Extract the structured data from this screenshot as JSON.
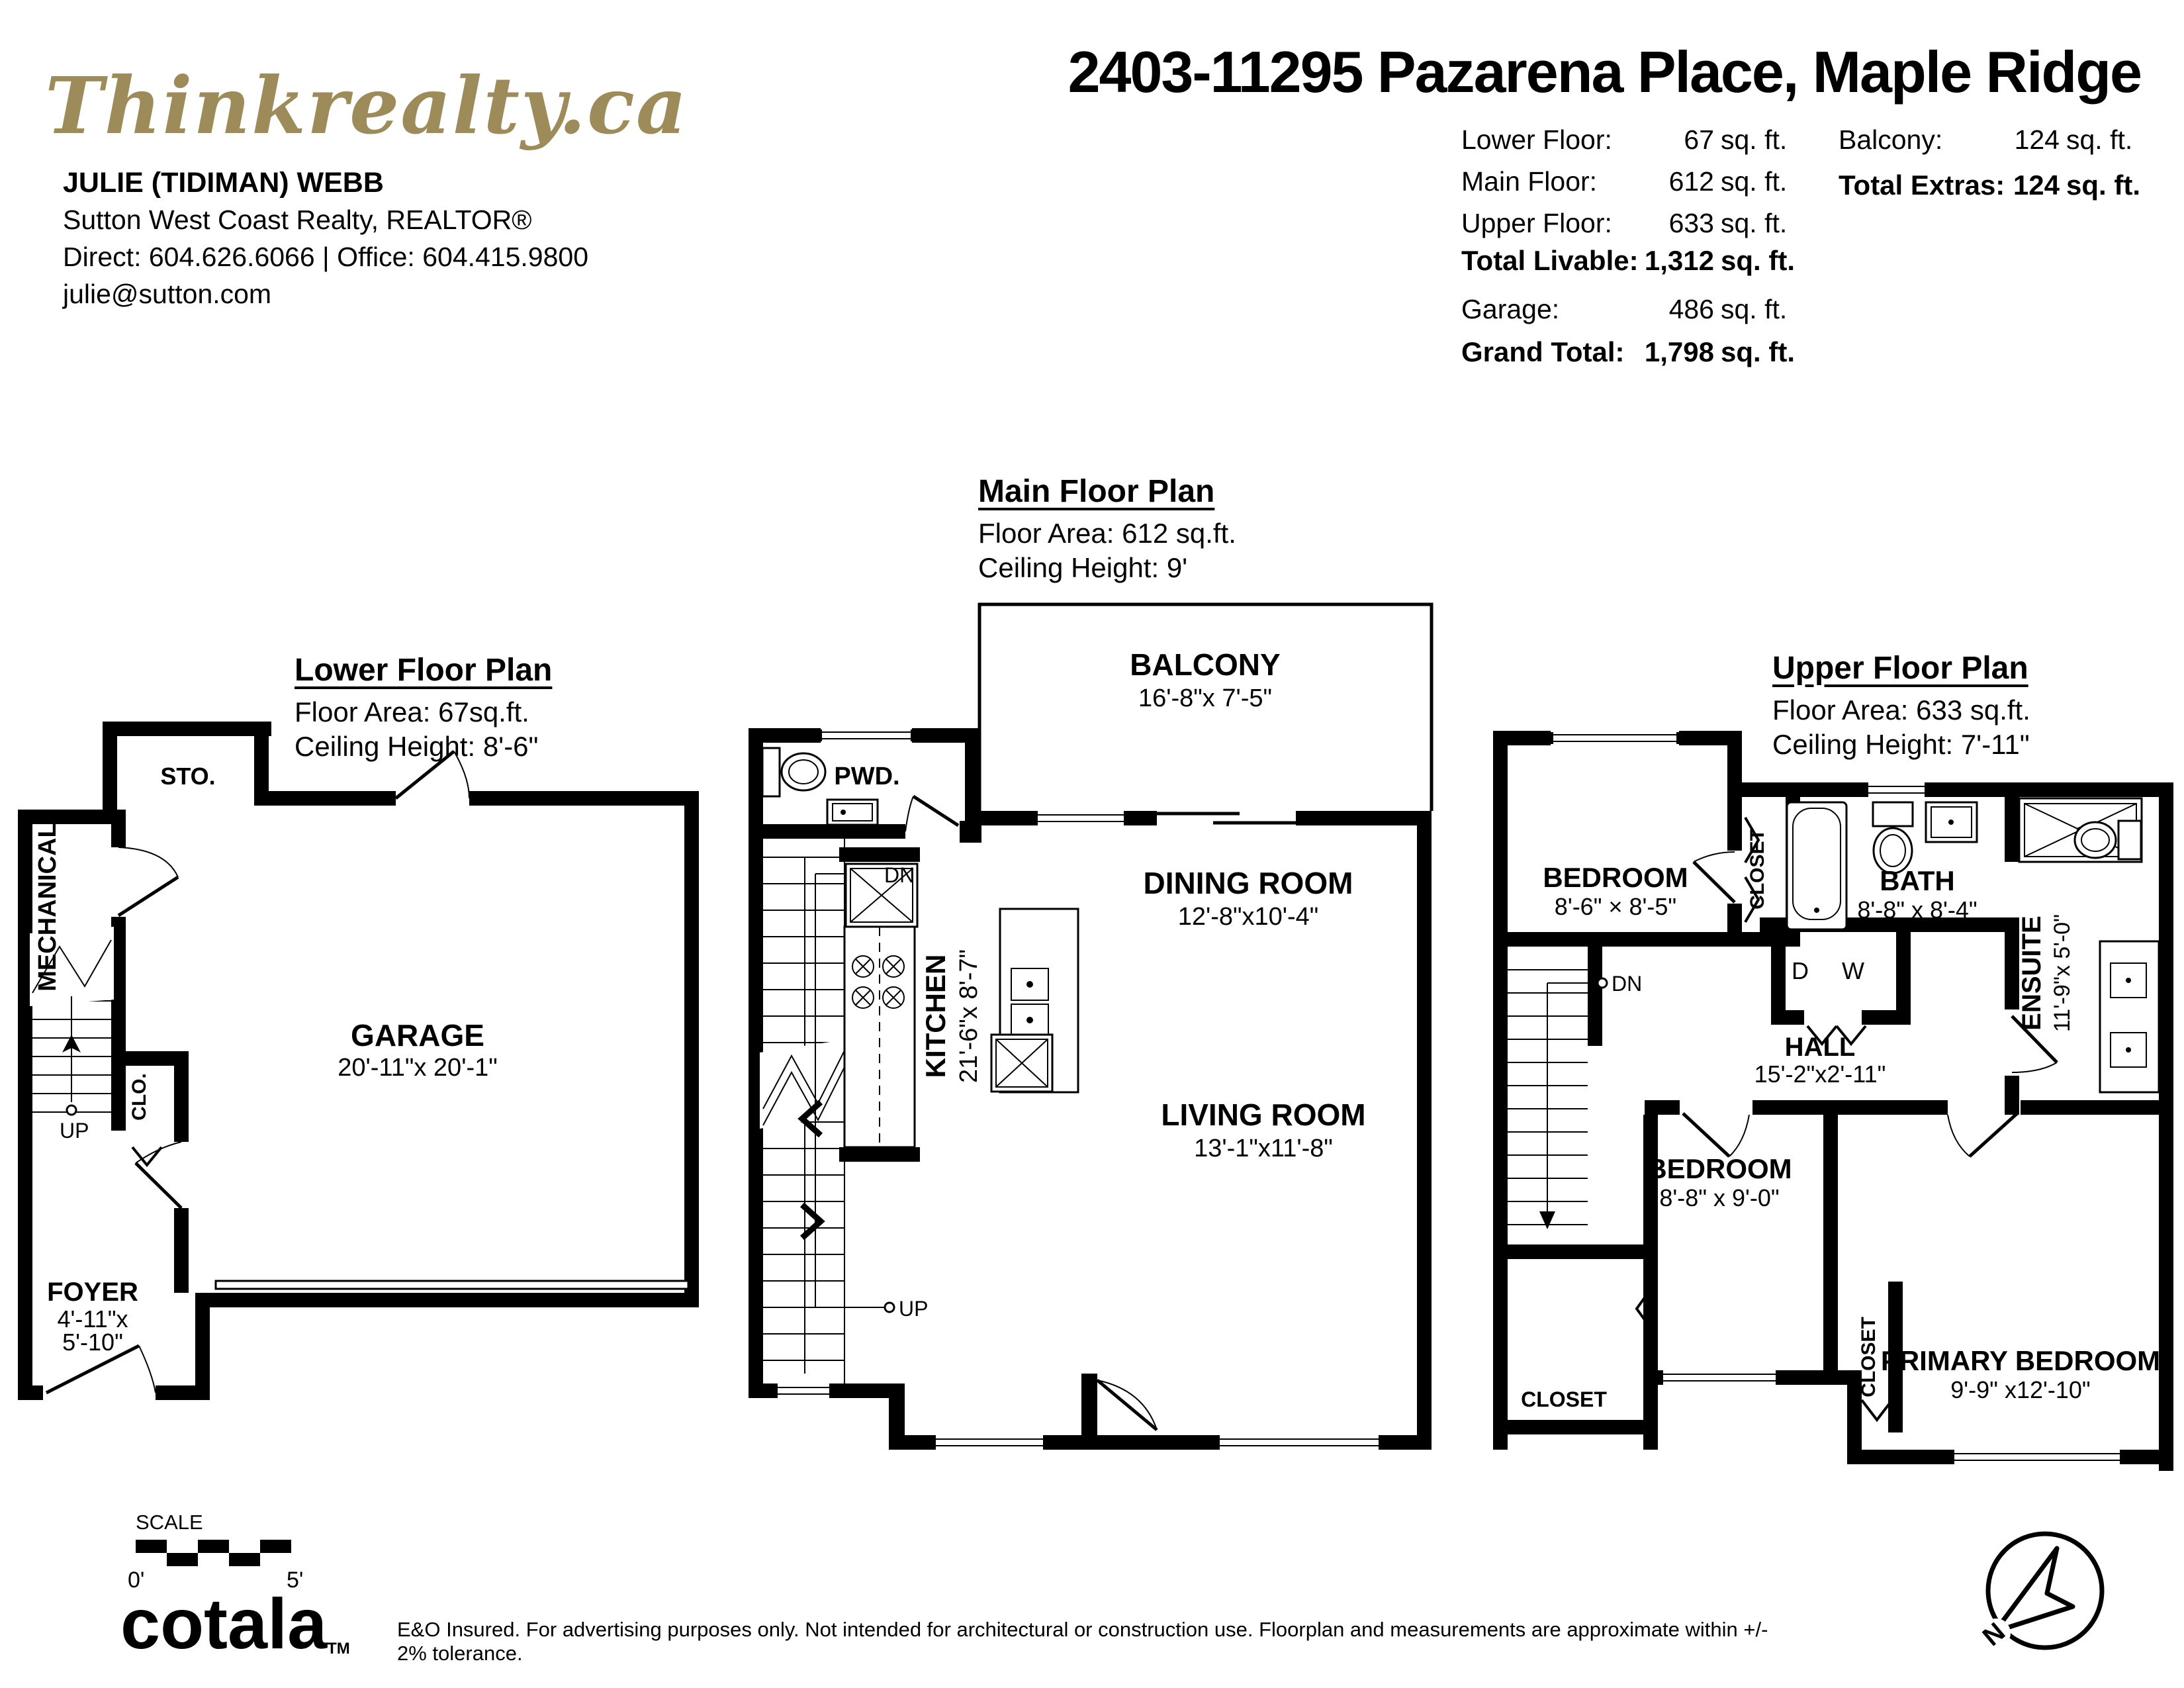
{
  "brand": {
    "logo_text": "Thinkrealty.ca",
    "logo_color": "#9d8c5a",
    "footer_brand": "cotala",
    "footer_brand_tm": "TM"
  },
  "agent": {
    "name": "JULIE (TIDIMAN) WEBB",
    "brokerage": "Sutton West Coast Realty, REALTOR®",
    "phones": "Direct: 604.626.6066 | Office: 604.415.9800",
    "email": "julie@sutton.com"
  },
  "title": "2403-11295 Pazarena Place, Maple Ridge",
  "summary": {
    "left_rows": [
      {
        "label": "Lower Floor:",
        "value": "67",
        "unit": "sq. ft."
      },
      {
        "label": "Main Floor:",
        "value": "612",
        "unit": "sq. ft."
      },
      {
        "label": "Upper Floor:",
        "value": "633",
        "unit": "sq. ft."
      },
      {
        "label": "Total Livable:",
        "value": "1,312",
        "unit": "sq. ft."
      },
      {
        "label": "Garage:",
        "value": "486",
        "unit": "sq. ft."
      },
      {
        "label": "Grand Total:",
        "value": "1,798",
        "unit": "sq. ft."
      }
    ],
    "right_rows": [
      {
        "label": "Balcony:",
        "value": "124",
        "unit": "sq. ft."
      },
      {
        "label": "Total Extras:",
        "value": "124",
        "unit": "sq. ft."
      }
    ]
  },
  "plans": {
    "lower": {
      "title": "Lower Floor Plan",
      "area": "Floor Area: 67sq.ft.",
      "ceiling": "Ceiling Height: 8'-6\"",
      "rooms": {
        "sto": "STO.",
        "mechanical": "MECHANICAL",
        "garage": "GARAGE",
        "garage_dims": "20'-11\"x 20'-1\"",
        "clo": "CLO.",
        "foyer": "FOYER",
        "foyer_dims1": "4'-11\"x",
        "foyer_dims2": "5'-10\"",
        "up": "UP"
      }
    },
    "main": {
      "title": "Main Floor Plan",
      "area": "Floor Area: 612 sq.ft.",
      "ceiling": "Ceiling Height: 9'",
      "rooms": {
        "pwd": "PWD.",
        "balcony": "BALCONY",
        "balcony_dims": "16'-8\"x 7'-5\"",
        "dn": "DN",
        "up": "UP",
        "dining": "DINING ROOM",
        "dining_dims": "12'-8\"x10'-4\"",
        "kitchen": "KITCHEN",
        "kitchen_dims": "21'-6\"x 8'-7\"",
        "living": "LIVING ROOM",
        "living_dims": "13'-1\"x11'-8\""
      }
    },
    "upper": {
      "title": "Upper Floor Plan",
      "area": "Floor Area: 633 sq.ft.",
      "ceiling": "Ceiling Height: 7'-11\"",
      "rooms": {
        "bedroom1": "BEDROOM",
        "bedroom1_dims": "8'-6\" × 8'-5\"",
        "closet1": "CLOSET",
        "bath": "BATH",
        "bath_dims": "8'-8\" x 8'-4\"",
        "ensuite": "ENSUITE",
        "ensuite_dims": "11'-9\"x 5'-0\"",
        "d": "D",
        "w": "W",
        "dn": "DN",
        "hall": "HALL",
        "hall_dims": "15'-2\"x2'-11\"",
        "bedroom2": "BEDROOM",
        "bedroom2_dims": "8'-8\" x 9'-0\"",
        "closet2": "CLOSET",
        "closet3": "CLOSET",
        "primary": "PRIMARY BEDROOM",
        "primary_dims": "9'-9\" x12'-10\""
      }
    }
  },
  "footer": {
    "scale_label": "SCALE",
    "scale_zero": "0'",
    "scale_five": "5'",
    "north": "N",
    "disclaimer": "E&O Insured. For advertising purposes only. Not intended for architectural or construction use. Floorplan and measurements are approximate within +/- 2% tolerance."
  }
}
